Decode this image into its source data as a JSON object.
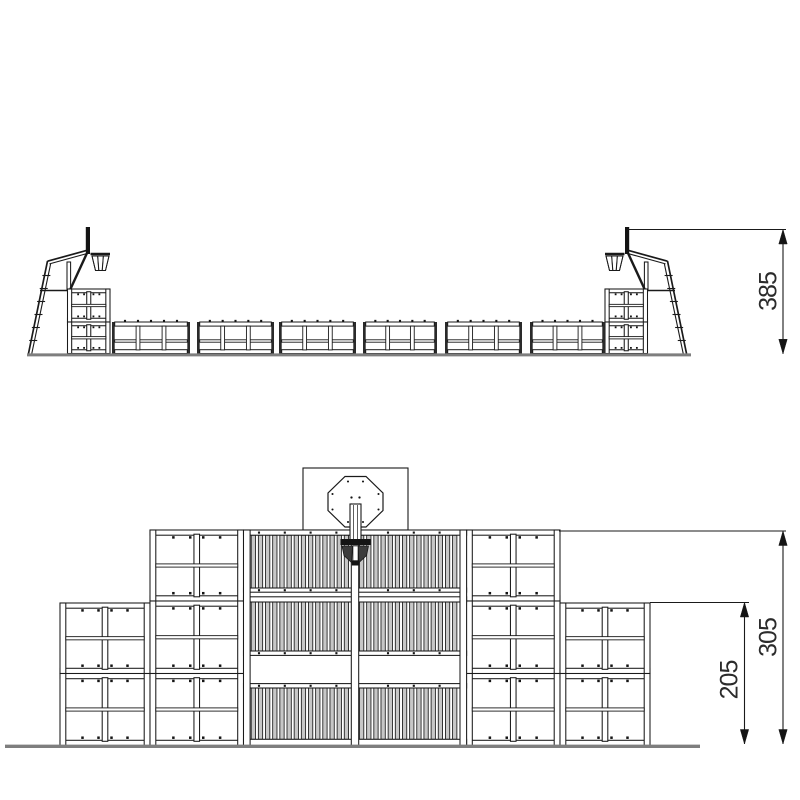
{
  "page": {
    "background": "#ffffff"
  },
  "style": {
    "stroke": "#1a1a1a",
    "ground": "#7e7e7e",
    "slat_fill": "#c7c7c7",
    "frame_fill": "#ffffff",
    "black_fill": "#141414",
    "net_fill": "#3c3c3c",
    "dim_text": "#2b2b2b"
  },
  "side_view": {
    "label": "side-elevation",
    "dim_height": "385"
  },
  "front_view": {
    "label": "front-elevation",
    "dim_total": "305",
    "dim_low": "205"
  }
}
